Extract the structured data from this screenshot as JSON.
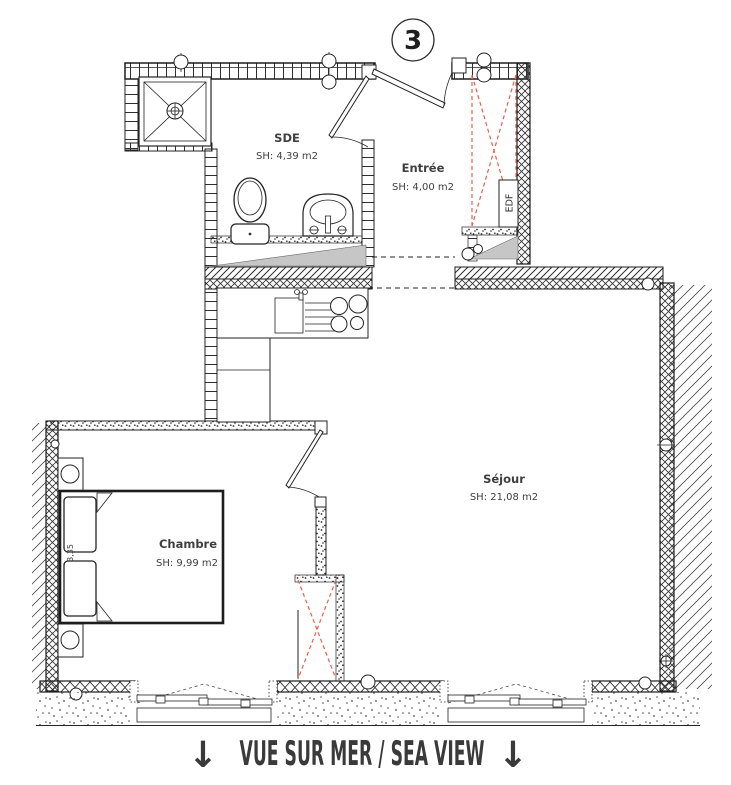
{
  "plan": {
    "unit_badge": "3",
    "rooms": {
      "sde": {
        "name": "SDE",
        "area": "SH: 4,39 m2"
      },
      "entree": {
        "name": "Entrée",
        "area": "SH: 4,00 m2"
      },
      "sejour": {
        "name": "Séjour",
        "area": "SH: 21,08 m2"
      },
      "chambre": {
        "name": "Chambre",
        "area": "SH: 9,99 m2"
      }
    },
    "annotations": {
      "electrical_panel": "EDF",
      "bed_dimension": "3,35"
    },
    "footer": {
      "arrow_left": "↓",
      "caption": "VUE SUR MER / SEA VIEW",
      "arrow_right": "↓"
    },
    "colors": {
      "line": "#232323",
      "closet_dashed_red": "#e8604c",
      "slope_fill_gray": "#c6c6c6",
      "label_text": "#3f3f3f",
      "footer_text": "#3a3a3a"
    }
  }
}
